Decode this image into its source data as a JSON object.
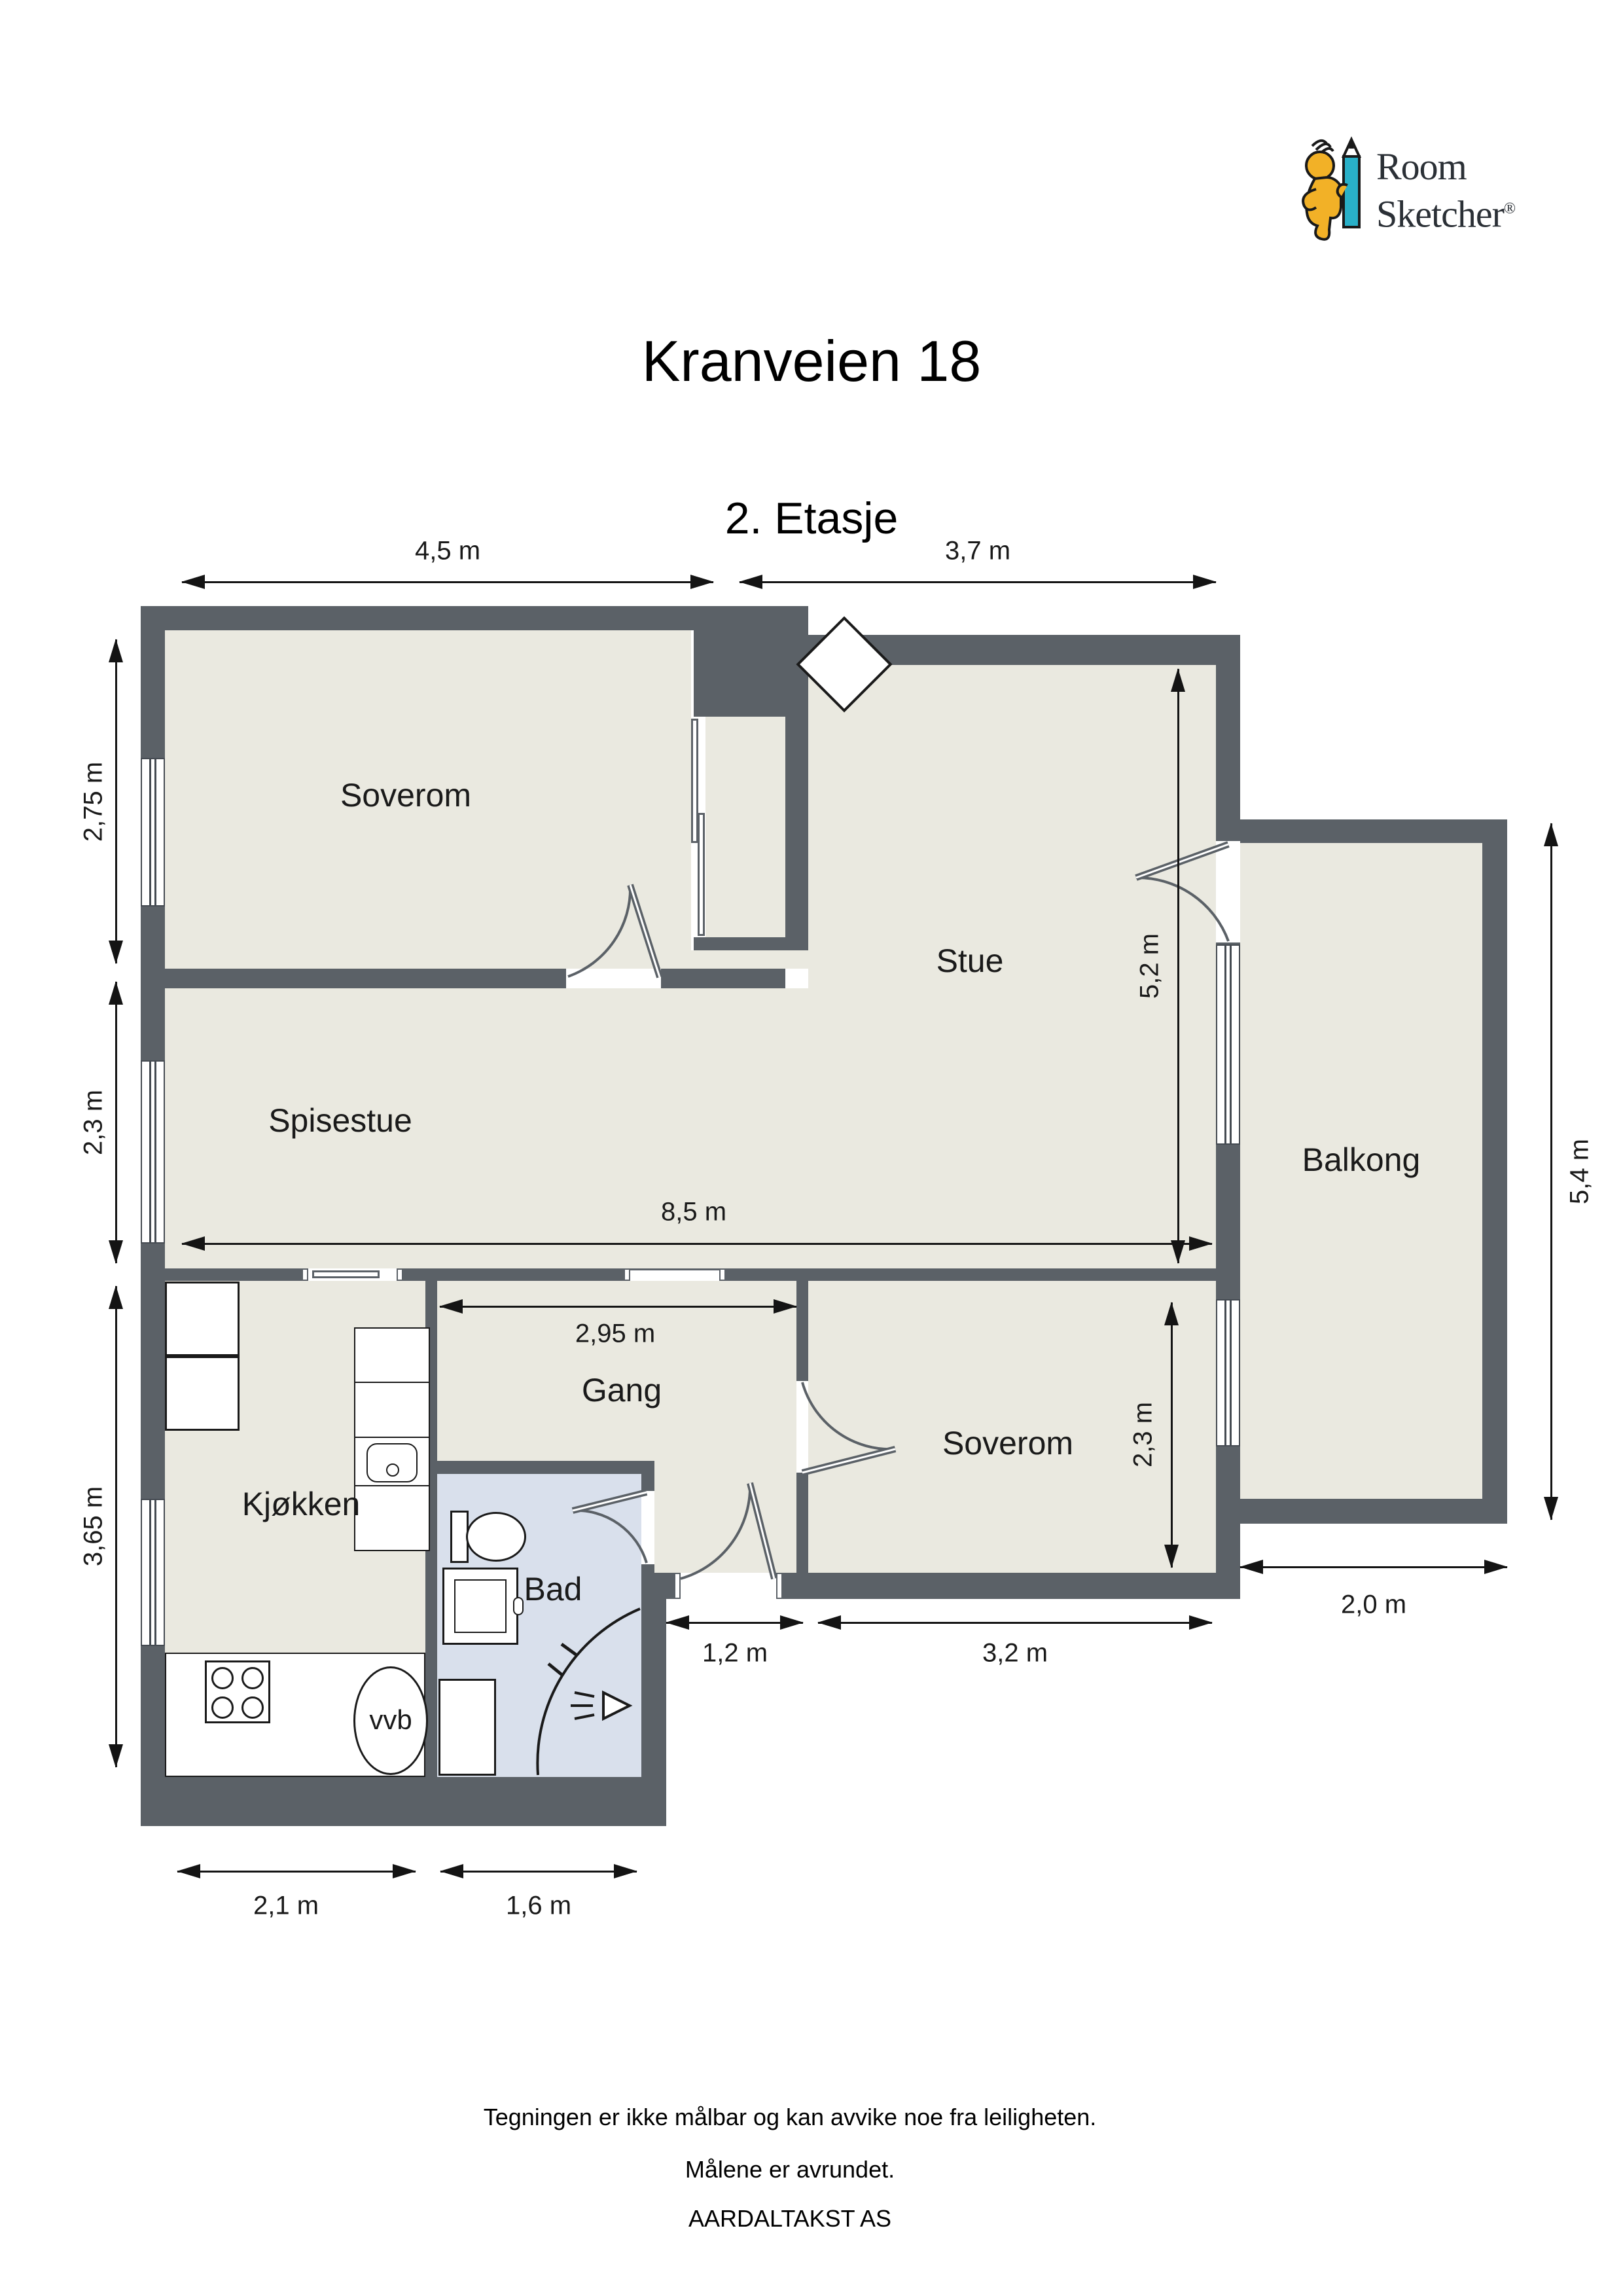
{
  "brand": {
    "name_line1": "Room",
    "name_line2": "Sketcher",
    "registered_mark": "®"
  },
  "header": {
    "title": "Kranveien 18",
    "floor_label": "2. Etasje"
  },
  "rooms": {
    "soverom_top": "Soverom",
    "stue": "Stue",
    "spisestue": "Spisestue",
    "balkong": "Balkong",
    "kjokken": "Kjøkken",
    "bad": "Bad",
    "gang": "Gang",
    "soverom_bottom": "Soverom"
  },
  "fixtures": {
    "water_heater_label": "vvb"
  },
  "dimensions": {
    "soverom_top_width": "4,5 m",
    "stue_width": "3,7 m",
    "soverom_top_height": "2,75 m",
    "spisestue_height": "2,3 m",
    "kjokken_height": "3,65 m",
    "stue_height": "5,2 m",
    "total_width": "8,5 m",
    "gang_width": "2,95 m",
    "entrance_width": "1,2 m",
    "soverom_bottom_width": "3,2 m",
    "soverom_bottom_height": "2,3 m",
    "balkong_height": "5,4 m",
    "balkong_width": "2,0 m",
    "kjokken_width": "2,1 m",
    "bad_width": "1,6 m"
  },
  "footer": {
    "disclaimer_line1": "Tegningen er ikke målbar og kan avvike noe fra leiligheten.",
    "disclaimer_line2": "Målene er avrundet.",
    "attribution": "AARDALTAKST AS"
  },
  "colors": {
    "wall": "#5b6167",
    "floor": "#eae9e0",
    "bathroom_floor": "#d9e0ec",
    "dimension_ink": "#141414",
    "logo_yellow": "#f2b127",
    "logo_teal": "#29b0c8"
  }
}
